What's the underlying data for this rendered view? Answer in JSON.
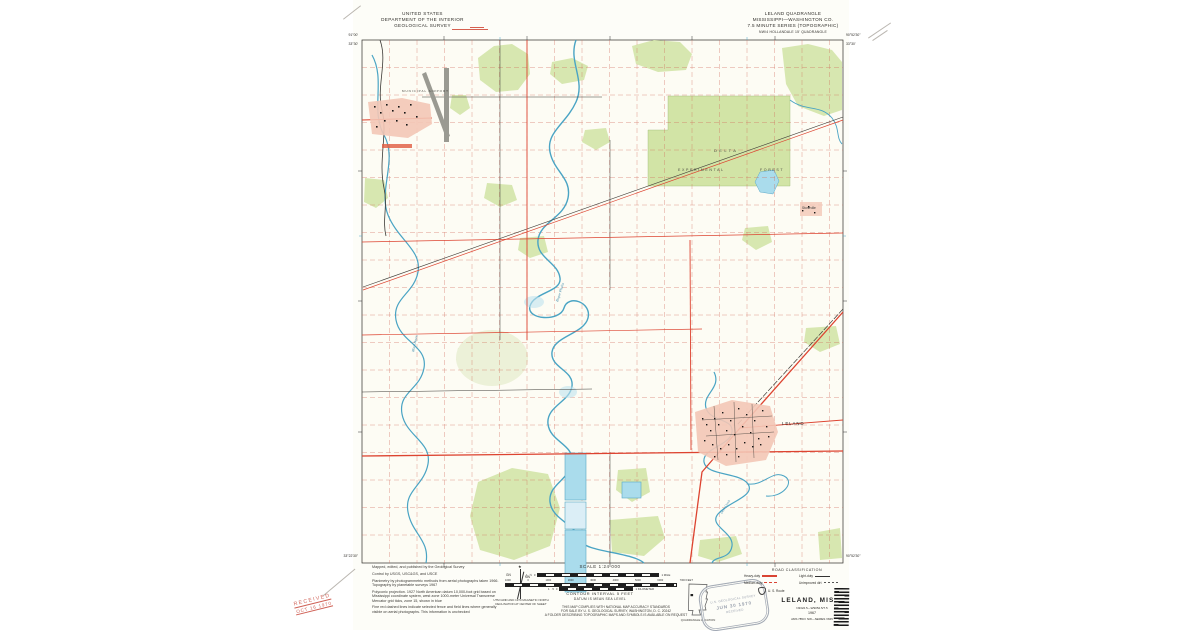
{
  "colors": {
    "paper": "#fdfdf8",
    "vegetation_green": "#d7e7b0",
    "water_blue": "#4aa4c4",
    "water_fill": "#b7dfee",
    "grid_red": "#cf6a58",
    "highway_red": "#dd4330",
    "urban_pink": "#f3c7b6"
  },
  "header": {
    "agency_line1": "UNITED STATES",
    "agency_line2": "DEPARTMENT OF THE INTERIOR",
    "agency_line3": "GEOLOGICAL SURVEY",
    "quad_line1": "LELAND QUADRANGLE",
    "quad_line2": "MISSISSIPPI—WASHINGTON CO.",
    "quad_line3": "7.5 MINUTE SERIES (TOPOGRAPHIC)",
    "quad_line4": "NW/4 HOLLANDALE 15' QUADRANGLE"
  },
  "corners": {
    "tl_lon": "91°00'",
    "tl_lat": "33°30'",
    "tr_lon": "90°52'30\"",
    "tr_lat": "33°30'",
    "bl_lat": "33°22'30\"",
    "br_lon": "90°52'30\""
  },
  "map_labels": {
    "municipal_airport": "MUNICIPAL AIRPORT",
    "delta": "DELTA",
    "experimental": "EXPERIMENTAL",
    "forest": "FOREST",
    "leland": "LELAND",
    "stoneville": "Stoneville",
    "bogue_phalia": "Bogue Phalia",
    "deer_creek": "Deer Creek",
    "black_bayou": "Black Bayou"
  },
  "credits": {
    "l1": "Mapped, edited, and published by the Geological Survey",
    "l2": "Control by USGS, USC&GS, and USCE",
    "l3": "Planimetry by photogrammetric methods from aerial photographs taken 1966.  Topography by planetable surveys 1967",
    "l4": "Polyconic projection.  1927 North American datum 10,000-foot grid based on Mississippi coordinate system, west zone 1000-meter Universal Transverse Mercator grid ticks, zone 15, shown in blue",
    "l5": "Fine red dashed lines indicate selected fence and field lines where generally visible on aerial photographs.  This information is unchecked"
  },
  "declination": {
    "star": "★",
    "gn": "GN",
    "mn": "MN",
    "caption1": "UTM GRID AND 1970 MAGNETIC NORTH",
    "caption2": "DECLINATION AT CENTER OF SHEET"
  },
  "scalebar": {
    "title": "SCALE 1:24 000",
    "miles_left": "1",
    "miles_mid": "½",
    "miles_zero": "0",
    "miles_right": "1 MILE",
    "feet_labels": [
      "1000",
      "0",
      "1000",
      "2000",
      "3000",
      "4000",
      "5000",
      "6000",
      "7000 FEET"
    ],
    "km_left": "1",
    "km_mid": ".5",
    "km_zero": "0",
    "km_right": "1 KILOMETER",
    "contour": "CONTOUR INTERVAL 5 FEET",
    "datum": "DATUM IS MEAN SEA LEVEL"
  },
  "accuracy": {
    "l1": "THIS MAP COMPLIES WITH NATIONAL MAP ACCURACY STANDARDS",
    "l2": "FOR SALE BY U. S. GEOLOGICAL SURVEY, WASHINGTON, D. C. 20242",
    "l3": "A FOLDER DESCRIBING TOPOGRAPHIC MAPS AND SYMBOLS IS AVAILABLE ON REQUEST"
  },
  "quad_location": {
    "caption": "QUADRANGLE LOCATION"
  },
  "road_classification": {
    "title": "ROAD CLASSIFICATION",
    "heavy": "Heavy-duty",
    "medium": "Medium-duty",
    "light": "Light-duty",
    "unimproved": "Unimproved dirt",
    "us_route": "U. S. Route"
  },
  "title_block": {
    "title": "LELAND, MISS.",
    "coords": "N3322.5—W9052.5/7.5",
    "year": "1967",
    "series": "AMS 7853 I NW—SERIES V845"
  },
  "stamps": {
    "survey_line1": "U.S. GEOLOGICAL SURVEY",
    "survey_line2": "JUN 30 1970",
    "survey_line3": "RECEIVED",
    "received_line1": "RECEIVED",
    "received_line2": "OCT 16 1970"
  }
}
